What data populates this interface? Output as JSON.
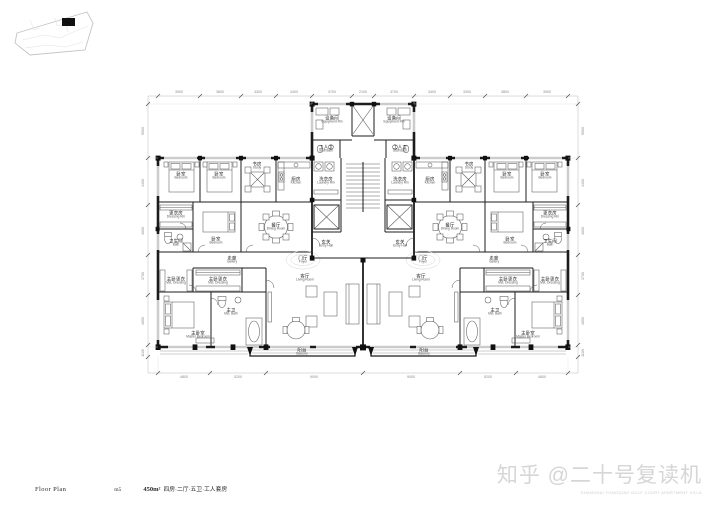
{
  "drawing": {
    "title_block": {
      "name": "Floor Plan",
      "code": "m5",
      "area": "450m²",
      "spec": "四房·二厅·五卫·工人套房"
    },
    "watermark": {
      "main": "知乎 @二十号复读机",
      "sub": "SHANGHAI YONGQIAO GOLF COURT APARTMENT VILLA"
    }
  },
  "room_labels": {
    "bedroom": {
      "zh": "卧室",
      "en": "Bedroom"
    },
    "study": {
      "zh": "书房",
      "en": "Study"
    },
    "kitchen": {
      "zh": "厨房",
      "en": "Kitchen"
    },
    "dressing": {
      "zh": "更衣房",
      "en": "Dressing Rm"
    },
    "bath": {
      "zh": "卫生间",
      "en": "Bath"
    },
    "dining": {
      "zh": "餐厅",
      "en": "Dining Room"
    },
    "gallery": {
      "zh": "走廊",
      "en": "Gallery"
    },
    "foyer": {
      "zh": "门厅",
      "en": "Foyer"
    },
    "entry": {
      "zh": "玄关",
      "en": "Entry Hall"
    },
    "laundry": {
      "zh": "洗衣房",
      "en": "Laundry Rm"
    },
    "equipment": {
      "zh": "设备间",
      "en": "Equipment Rm"
    },
    "staff_bath": {
      "zh": "工人卫",
      "en": "Staff Bath"
    },
    "mst_dressing": {
      "zh": "主卧更衣",
      "en": "Mst. Dressing"
    },
    "mst_bath": {
      "zh": "主卫",
      "en": "Mst. Bath"
    },
    "master": {
      "zh": "主卧室",
      "en": "Master Bedroom"
    },
    "living": {
      "zh": "客厅",
      "en": "Living Room"
    },
    "balcony": {
      "zh": "阳台",
      "en": "Balcony"
    }
  },
  "dims": {
    "top": [
      "3900",
      "3800",
      "3300",
      "3400",
      "3700",
      "2100",
      "3700",
      "3400",
      "3300",
      "3800",
      "3900"
    ],
    "bottom": [
      "4800",
      "5200",
      "9000",
      "9000",
      "5200",
      "4800"
    ],
    "left": [
      "5000",
      "4400",
      "4600",
      "3700",
      "4600",
      "1100"
    ],
    "right": [
      "5000",
      "4400",
      "4600",
      "3700",
      "4600",
      "1100"
    ]
  },
  "colors": {
    "line": "#1c1c1c",
    "dim_line": "#b8b8b8",
    "dim_text": "#8a8a8a",
    "label": "#1e1e1e",
    "label_en": "#555555",
    "watermark": "#d6d6d6",
    "keyplan": "#c4c4c4"
  }
}
